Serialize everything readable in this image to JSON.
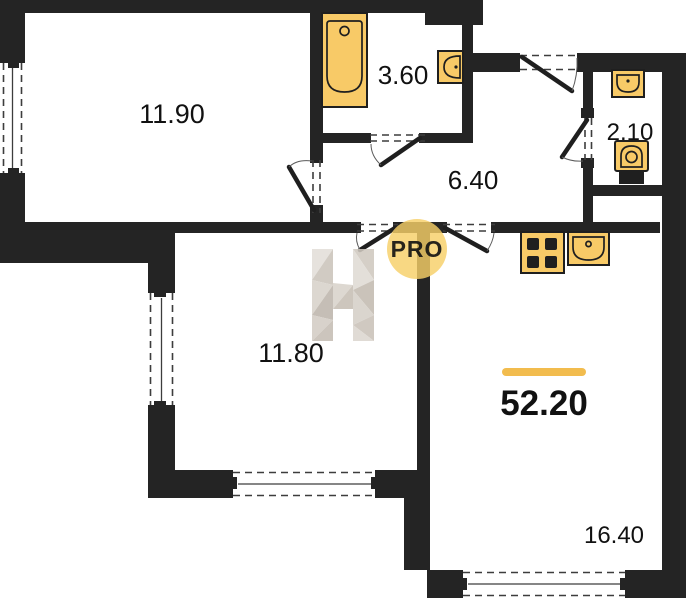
{
  "colors": {
    "wall": "#242424",
    "fixture_fill": "#F8CA67",
    "fixture_stroke": "#1F1F1F",
    "accent_line": "#F2BC4E",
    "watermark_circle": "#F6CF68",
    "watermark_text": "#95908A",
    "label": "#111111"
  },
  "watermark": {
    "letter": "H",
    "badge": "PRO"
  },
  "total_area": {
    "value": "52.20"
  },
  "rooms": [
    {
      "name": "bedroom-top-left",
      "area": "11.90"
    },
    {
      "name": "bathroom",
      "area": "3.60"
    },
    {
      "name": "hallway",
      "area": "6.40"
    },
    {
      "name": "wc",
      "area": "2.10"
    },
    {
      "name": "room-bottom-left",
      "area": "11.80"
    },
    {
      "name": "living-kitchen",
      "area": "16.40"
    }
  ],
  "fixtures": [
    "bathtub-icon",
    "bath-sink-icon",
    "wc-sink-icon",
    "toilet-icon",
    "stove-icon",
    "kitchen-sink-icon"
  ]
}
